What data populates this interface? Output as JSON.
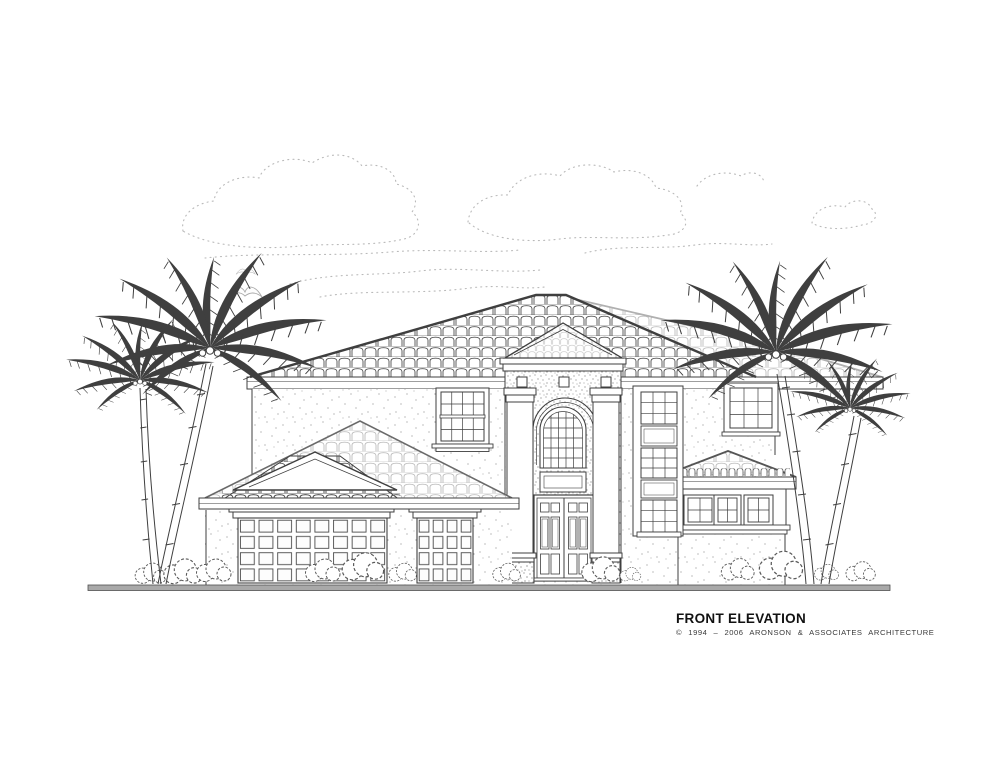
{
  "canvas": {
    "width": 1000,
    "height": 772,
    "background": "#ffffff"
  },
  "palette": {
    "ink": "#3f3f3f",
    "light_ink": "#bdbdbd",
    "stipple": "#9c9c9c",
    "stone_speckle": "#8a8a8a",
    "ground": "#a9a9a9",
    "cloud_dots": "#b9b9b9",
    "text": "#111111"
  },
  "caption": {
    "title": "FRONT ELEVATION",
    "copyright": "© 1994 – 2006 ARONSON & ASSOCIATES ARCHITECTURE"
  },
  "scene": {
    "type": "architectural front elevation line drawing of a two-story house",
    "elements": [
      "stippled clouds",
      "two seagulls",
      "left palm tree pair",
      "right palm tree pair",
      "spanish tile hip roof",
      "entry tower with tiled pediment",
      "arched window",
      "double entry doors",
      "double-hung left window",
      "stacked stair windows",
      "right upper window",
      "single-story right bay with hip roof",
      "three bay windows",
      "garage wing with hip roof and front gable",
      "double garage door",
      "single garage door",
      "shrubs",
      "ground line"
    ]
  }
}
